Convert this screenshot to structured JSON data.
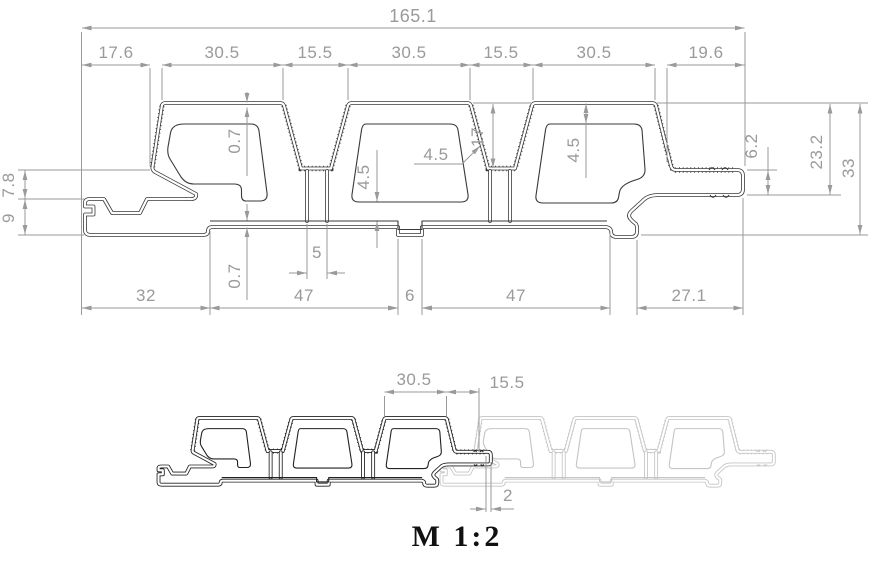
{
  "colors": {
    "background": "#ffffff",
    "profile_line": "#3a3a3a",
    "assembly_profile_dark": "#222222",
    "assembly_profile_light": "#c4c4c4",
    "dimension_line": "#9a9a9a",
    "scale_label_color": "#111111"
  },
  "top_view": {
    "overall_width": "165.1",
    "width_chain": [
      "17.6",
      "30.5",
      "15.5",
      "30.5",
      "15.5",
      "30.5",
      "19.6"
    ],
    "left_heights": {
      "upper": "7.8",
      "lower": "9"
    },
    "wall_details": {
      "skin_top": "0.7",
      "skin_bottom": "0.7",
      "wall_left": "4.5",
      "wall_mid": "4.5",
      "wall_right": "4.5",
      "groove_depth": "17",
      "support_width": "5"
    },
    "right_heights": {
      "tongue_thickness": "6.2",
      "tongue_to_top": "23.2",
      "overall_height": "33"
    },
    "bottom_chain": [
      "32",
      "47",
      "6",
      "47",
      "27.1"
    ]
  },
  "assembly_view": {
    "rib_width": "30.5",
    "groove_width": "15.5",
    "joint_gap": "2",
    "scale_label": "M 1:2"
  }
}
